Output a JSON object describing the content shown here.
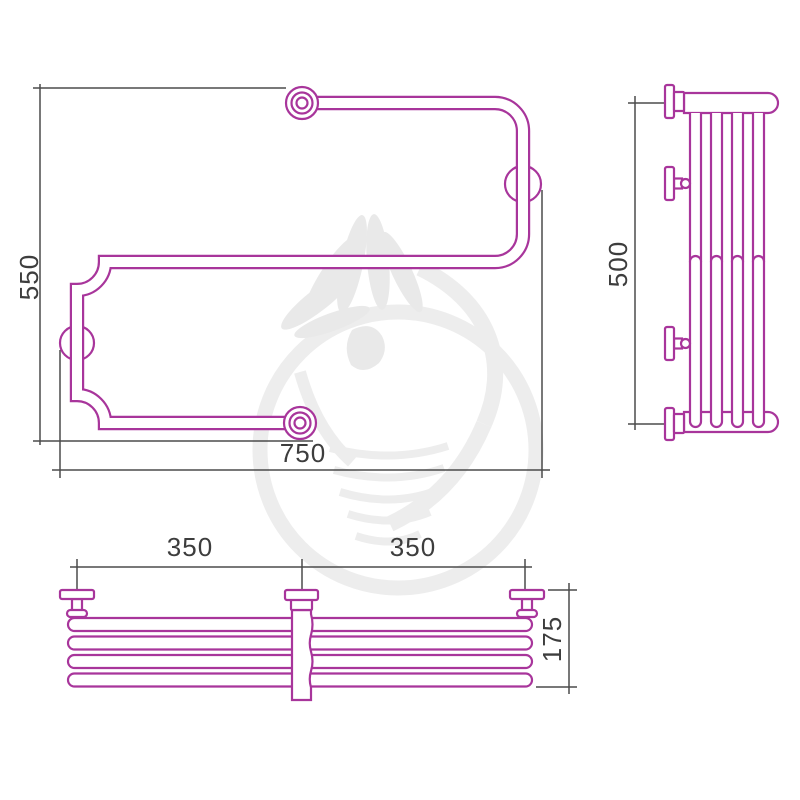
{
  "drawing": {
    "kind": "technical drawing, S-shaped towel rail, three orthographic views",
    "colors": {
      "product_outline": "#a8359b",
      "dimension_lines": "#4b4b4b",
      "dimension_text": "#3d3d3d",
      "watermark": "#ececec",
      "background": "#ffffff"
    },
    "views": {
      "front": {
        "name": "front view",
        "height_mm": "550",
        "width_mm": "750"
      },
      "side": {
        "name": "side view",
        "height_mm": "500"
      },
      "plan": {
        "name": "plan view",
        "left_span_mm": "350",
        "right_span_mm": "350",
        "depth_mm": "175"
      }
    },
    "watermark_description": "light gray logo: woman with towel headdress inside circle"
  }
}
